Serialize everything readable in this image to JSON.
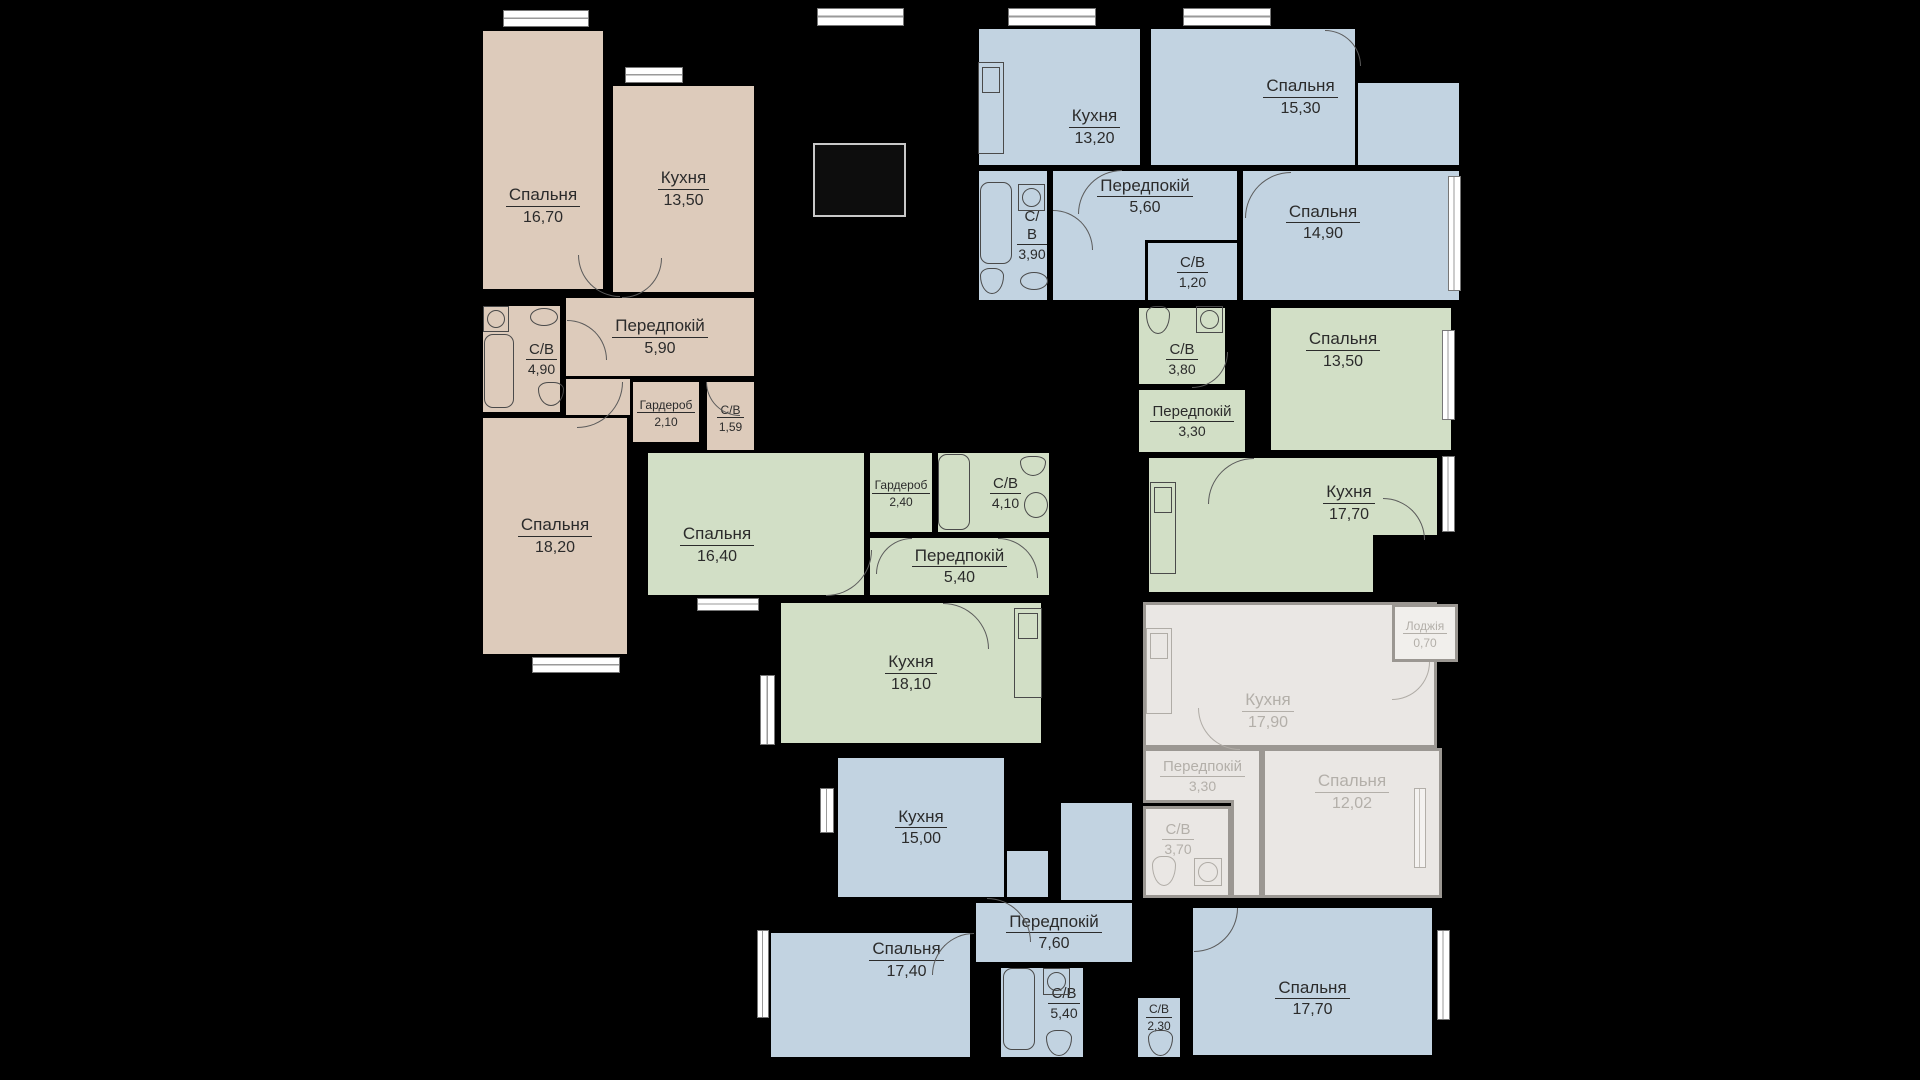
{
  "plan_title": "floor-plan",
  "colors": {
    "background": "#000000",
    "apartment_tan": "#ddcbbb",
    "apartment_blue": "#c2d3e1",
    "apartment_green": "#d2dfc6",
    "apartment_gray_fill": "#eae7e4",
    "apartment_gray_wall": "#9b9792",
    "apartment_gray_text": "#b3afa9",
    "wall": "#000000",
    "label_text": "#2b2b2b",
    "window_fill": "#ffffff"
  },
  "apartments": [
    {
      "id": "apartment-tan-top-left",
      "color": "#ddcbbb",
      "rooms": [
        {
          "name": "Спальня",
          "area": "16,70"
        },
        {
          "name": "Кухня",
          "area": "13,50"
        },
        {
          "name": "С/В",
          "area": "4,90"
        },
        {
          "name": "Передпокій",
          "area": "5,90"
        },
        {
          "name": "Гардероб",
          "area": "2,10"
        },
        {
          "name": "С/В",
          "area": "1,59"
        },
        {
          "name": "Спальня",
          "area": "18,20"
        }
      ]
    },
    {
      "id": "apartment-blue-top-right",
      "color": "#c2d3e1",
      "rooms": [
        {
          "name": "Кухня",
          "area": "13,20"
        },
        {
          "name": "Спальня",
          "area": "15,30"
        },
        {
          "name": "С/В",
          "area": "3,90"
        },
        {
          "name": "Передпокій",
          "area": "5,60"
        },
        {
          "name": "С/В",
          "area": "1,20"
        },
        {
          "name": "Спальня",
          "area": "14,90"
        }
      ]
    },
    {
      "id": "apartment-green-right",
      "color": "#d2dfc6",
      "rooms": [
        {
          "name": "С/В",
          "area": "3,80"
        },
        {
          "name": "Спальня",
          "area": "13,50"
        },
        {
          "name": "Передпокій",
          "area": "3,30"
        },
        {
          "name": "Кухня",
          "area": "17,70"
        }
      ]
    },
    {
      "id": "apartment-green-middle",
      "color": "#d2dfc6",
      "rooms": [
        {
          "name": "Спальня",
          "area": "16,40"
        },
        {
          "name": "Гардероб",
          "area": "2,40"
        },
        {
          "name": "С/В",
          "area": "4,10"
        },
        {
          "name": "Передпокій",
          "area": "5,40"
        },
        {
          "name": "Кухня",
          "area": "18,10"
        }
      ]
    },
    {
      "id": "apartment-gray-muted",
      "color": "#eae7e4",
      "rooms": [
        {
          "name": "Кухня",
          "area": "17,90"
        },
        {
          "name": "Лоджія",
          "area": "0,70"
        },
        {
          "name": "Передпокій",
          "area": "3,30"
        },
        {
          "name": "Спальня",
          "area": "12,02"
        },
        {
          "name": "С/В",
          "area": "3,70"
        }
      ]
    },
    {
      "id": "apartment-blue-bottom",
      "color": "#c2d3e1",
      "rooms": [
        {
          "name": "Кухня",
          "area": "15,00"
        },
        {
          "name": "Передпокій",
          "area": "7,60"
        },
        {
          "name": "Спальня",
          "area": "17,40"
        },
        {
          "name": "С/В",
          "area": "5,40"
        },
        {
          "name": "С/В",
          "area": "2,30"
        },
        {
          "name": "Спальня",
          "area": "17,70"
        }
      ]
    }
  ]
}
